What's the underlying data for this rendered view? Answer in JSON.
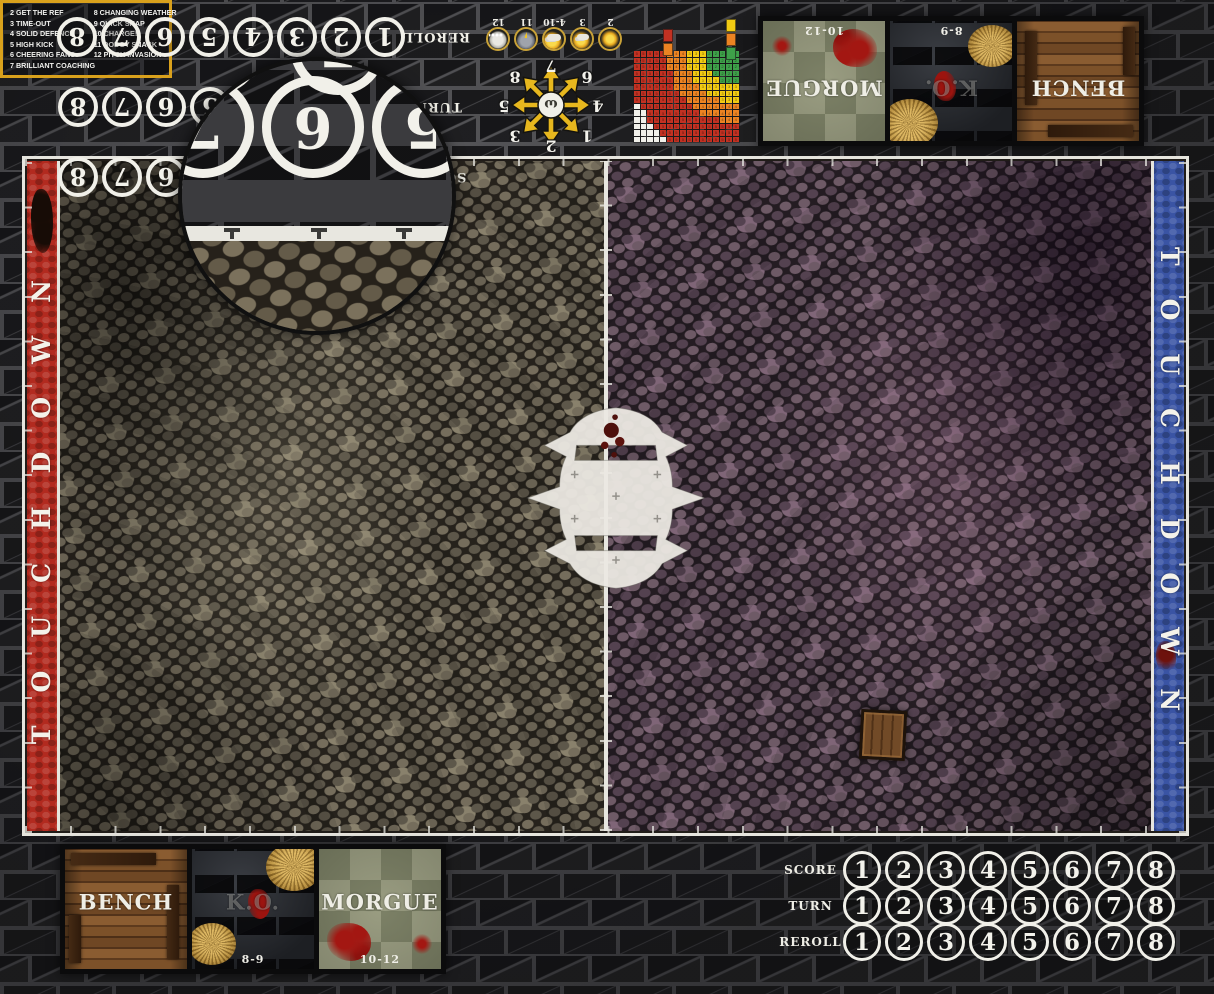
{
  "product": {
    "description": "Cobblestone street Blood Bowl fantasy football playmat"
  },
  "touchdown_left": "TOUCHDOWN",
  "touchdown_right": "TOUCHDOWN",
  "tracks": {
    "rows": [
      {
        "label": "SCORE",
        "numbers": [
          "1",
          "2",
          "3",
          "4",
          "5",
          "6",
          "7",
          "8"
        ]
      },
      {
        "label": "TURN",
        "numbers": [
          "1",
          "2",
          "3",
          "4",
          "5",
          "6",
          "7",
          "8"
        ]
      },
      {
        "label": "REROLL",
        "numbers": [
          "1",
          "2",
          "3",
          "4",
          "5",
          "6",
          "7",
          "8"
        ]
      }
    ]
  },
  "magnifier": {
    "main_numbers": [
      "5",
      "6",
      "7",
      "8"
    ],
    "partial_numbers": [
      "7",
      "6"
    ],
    "crosshair": "+"
  },
  "weather": {
    "cells": [
      {
        "label": "2",
        "icon": "sun-icon"
      },
      {
        "label": "3",
        "icon": "sun-small-cloud-icon"
      },
      {
        "label": "4-10",
        "icon": "sun-cloud-icon"
      },
      {
        "label": "11",
        "icon": "rain-cloud-icon"
      },
      {
        "label": "12",
        "icon": "snow-cloud-icon"
      }
    ]
  },
  "scatter": {
    "center_icon": "hand-of-nuffle-icon",
    "numbers": [
      {
        "n": "1",
        "x": -36,
        "y": -31
      },
      {
        "n": "2",
        "x": 0,
        "y": -41
      },
      {
        "n": "3",
        "x": 36,
        "y": -31
      },
      {
        "n": "4",
        "x": -47,
        "y": -1
      },
      {
        "n": "5",
        "x": 47,
        "y": -1
      },
      {
        "n": "6",
        "x": -36,
        "y": 28
      },
      {
        "n": "7",
        "x": 0,
        "y": 39
      },
      {
        "n": "8",
        "x": 36,
        "y": 28
      }
    ]
  },
  "range_ruler": {
    "type": "heatmap",
    "cols": 16,
    "rows": 14,
    "origin": "top-right",
    "bands": [
      {
        "name": "quick-pass",
        "color": "#3ea049",
        "max": 4.5,
        "digit": "2"
      },
      {
        "name": "short-pass",
        "color": "#f2cb13",
        "max": 7.4,
        "digit": "3"
      },
      {
        "name": "long-pass",
        "color": "#ec8322",
        "max": 10.4,
        "digit": "4"
      },
      {
        "name": "long-bomb",
        "color": "#c23122",
        "max": 16.6,
        "digit": "5"
      },
      {
        "name": "out-of-range",
        "color": "#f1f0ea",
        "max": 99,
        "digit": ""
      }
    ],
    "legend_left": [
      "#c23122",
      "#ec8322"
    ],
    "legend_right": [
      "#f2cb13",
      "#ec8322",
      "#3ea049"
    ]
  },
  "dugouts_top": {
    "boxes": [
      {
        "label": "MORGUE",
        "range": "10-12",
        "style": "tiles"
      },
      {
        "label": "K.O.",
        "range": "8-9",
        "style": "stone"
      },
      {
        "label": "BENCH",
        "range": "",
        "style": "wood"
      }
    ]
  },
  "dugouts_bottom": {
    "boxes": [
      {
        "label": "BENCH",
        "range": "",
        "style": "wood"
      },
      {
        "label": "K.O.",
        "range": "8-9",
        "style": "stone"
      },
      {
        "label": "MORGUE",
        "range": "10-12",
        "style": "tiles"
      }
    ]
  },
  "kickoff": {
    "left": [
      "2 GET THE REF",
      "3 TIME-OUT",
      "4 SOLID DEFENCE",
      "5 HIGH KICK",
      "6 CHEERING FANS",
      "7 BRILLIANT COACHING"
    ],
    "right": [
      "8 CHANGING WEATHER",
      "9 QUICK SNAP",
      "10 CHARGE!",
      "11 DODGY SNACK",
      "12 PITCH INVASION"
    ]
  },
  "colors": {
    "endzone_red": "#b22a1f",
    "endzone_blue": "#3a54a4",
    "line_white": "#e6e5de",
    "kickoff_border": "#d9a11c",
    "scatter_yellow": "#e7b71e"
  }
}
